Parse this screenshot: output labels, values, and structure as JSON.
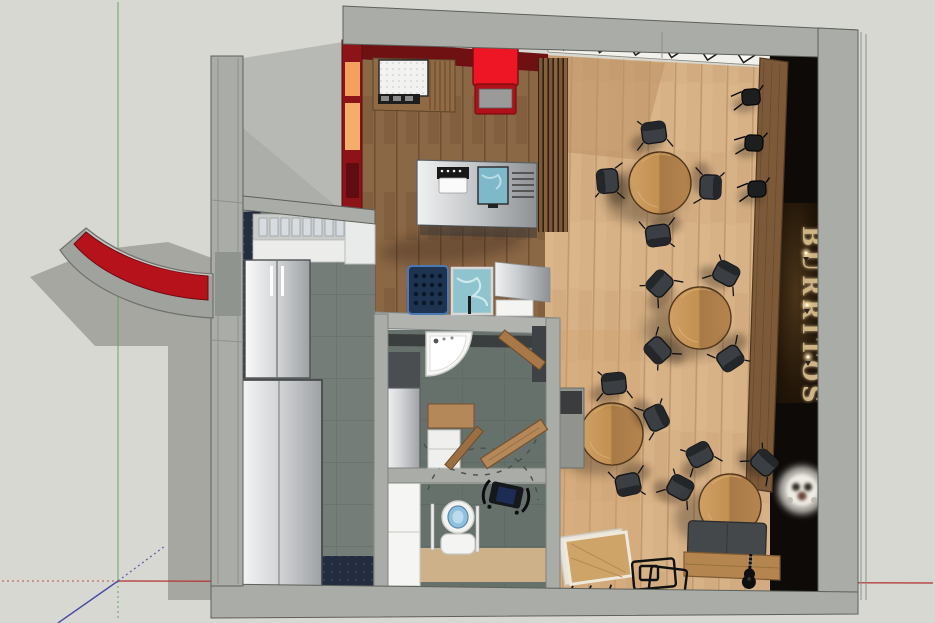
{
  "viewport": {
    "label": "3D restaurant floor plan viewport",
    "sign_text": "BURRITOS"
  },
  "palette": {
    "background": "#d8d8d2",
    "concrete_wall": "#a9aca7",
    "interior_red_wall": "#6f1013",
    "awning_red": "#b5121c",
    "cart_red": "#ee1524",
    "dining_wood": "#d8b287",
    "kitchen_wood": "#8a6745",
    "tile_gray": "#747d78",
    "dark_feature_wall": "#0d0a08",
    "sign_letters": "#d2b787",
    "axis_red": "#b03030",
    "axis_green": "#5fa05f",
    "axis_blue": "#4949a8"
  }
}
